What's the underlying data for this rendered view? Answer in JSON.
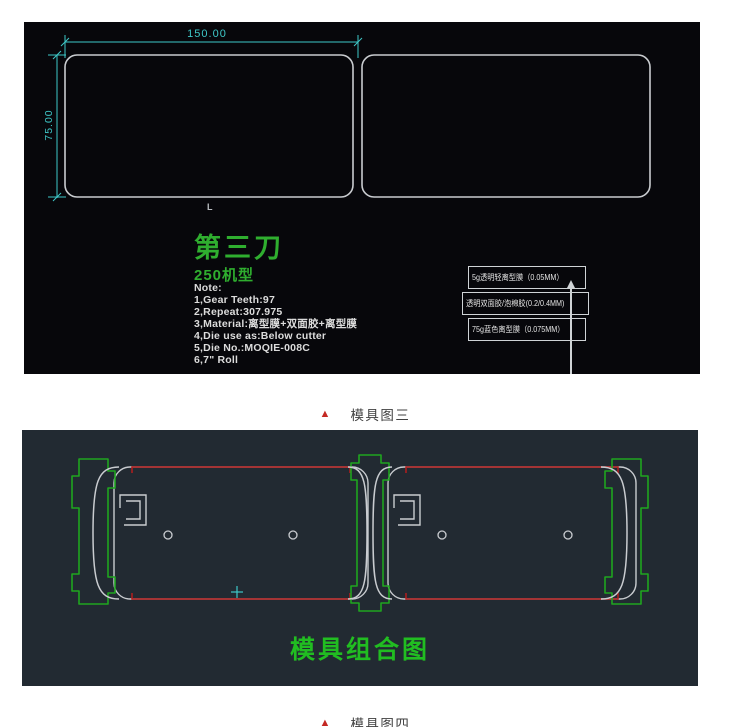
{
  "panel1": {
    "dim_width": "150.00",
    "dim_height": "75.00",
    "corner_mark": "L",
    "title": "第三刀",
    "machine": "250机型",
    "notes": [
      "Note:",
      "1,Gear Teeth:97",
      "2,Repeat:307.975",
      "3,Material:离型膜+双面胶+离型膜",
      "4,Die use as:Below cutter",
      "5,Die No.:MOQIE-008C",
      "6,7\" Roll"
    ],
    "layers": [
      "5g透明轻离型膜（0.05MM）",
      "透明双面胶/泡棉胶(0.2/0.4MM)",
      "75g蓝色离型膜（0.075MM）"
    ]
  },
  "panel2": {
    "title": "模具组合图"
  },
  "captions": {
    "marker": "▲",
    "fig3": "模具图三",
    "fig4": "模具图四"
  },
  "colors": {
    "panel1_bg": "#07070b",
    "panel2_bg": "#222a32",
    "cad_cyan": "#3ec8c8",
    "cad_green": "#2fae2f",
    "assembly_green": "#21bd21",
    "cad_red": "#b41c1c",
    "line_white": "#c9ccd0",
    "caption_red": "#c42823"
  }
}
